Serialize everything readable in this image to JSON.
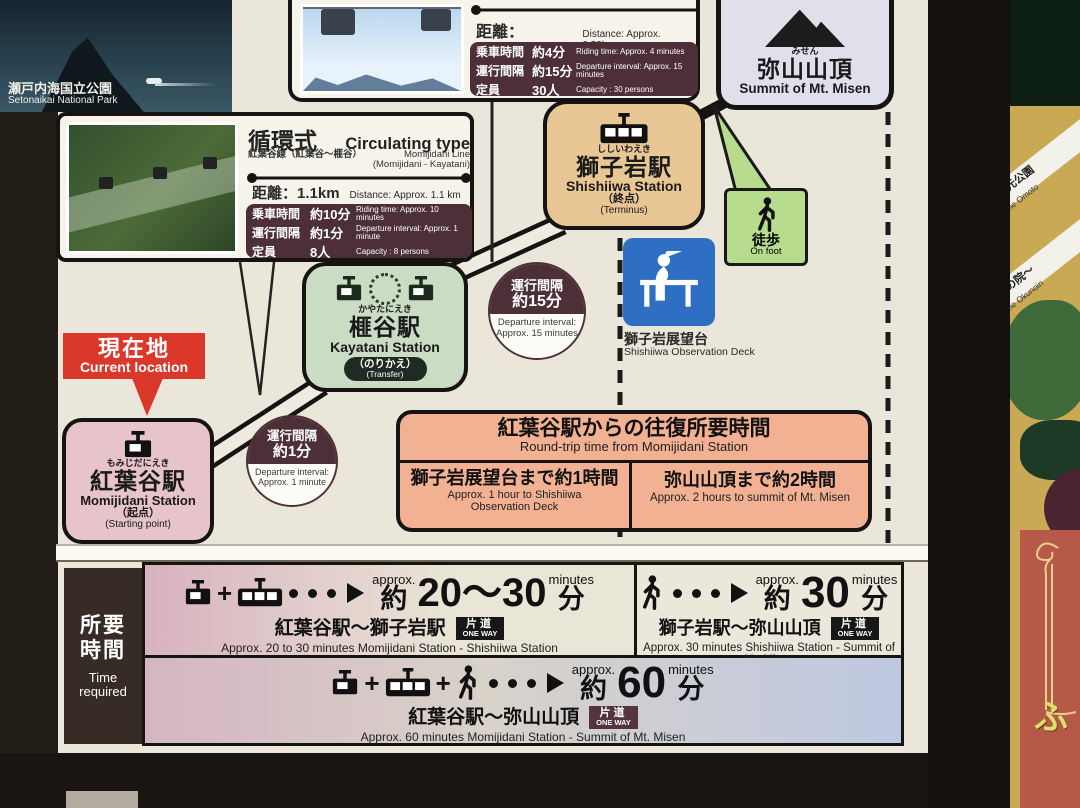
{
  "sign": {
    "island": {
      "jp": "瀬戸内海国立公園",
      "en": "Setonaikai National Park"
    },
    "top_line": {
      "distance_jp": "距離：0.52km",
      "distance_en": "Distance: Approx. 0.52km",
      "riding_jp": "乗車時間",
      "riding_v": "約4分",
      "riding_en": "Riding time: Approx. 4 minutes",
      "interval_jp": "運行間隔",
      "interval_v": "約15分",
      "interval_en": "Departure interval: Approx. 15 minutes",
      "capacity_jp": "定員",
      "capacity_v": "30人",
      "capacity_en": "Capacity : 30 persons"
    },
    "left_line": {
      "type_jp": "循環式",
      "type_en": "Circulating type",
      "line_jp": "紅葉谷線（紅葉谷〜榧谷）",
      "line_en1": "Momijidani Line",
      "line_en2": "(Momijidani - Kayatani)",
      "distance_jp": "距離：1.1km",
      "distance_en": "Distance: Approx. 1.1 km",
      "riding_jp": "乗車時間",
      "riding_v": "約10分",
      "riding_en": "Riding time: Approx. 10 minutes",
      "interval_jp": "運行間隔",
      "interval_v": "約1分",
      "interval_en": "Departure interval: Approx. 1 minute",
      "capacity_jp": "定員",
      "capacity_v": "8人",
      "capacity_en": "Capacity : 8 persons"
    },
    "summit": {
      "furigana": "みせん",
      "jp": "弥山山頂",
      "en": "Summit of Mt. Misen"
    },
    "stations": {
      "shishiiwa": {
        "furigana": "ししいわえき",
        "jp": "獅子岩駅",
        "en": "Shishiiwa Station",
        "note_jp": "（終点）",
        "note_en": "(Terminus)"
      },
      "kayatani": {
        "furigana": "かやたにえき",
        "jp": "榧谷駅",
        "en": "Kayatani Station",
        "note_jp": "（のりかえ）",
        "note_en": "(Transfer)"
      },
      "momijidani": {
        "furigana": "もみじだにえき",
        "jp": "紅葉谷駅",
        "en": "Momijidani Station",
        "note_jp": "（起点）",
        "note_en": "(Starting point)"
      }
    },
    "onfoot": {
      "jp": "徒歩",
      "en": "On foot"
    },
    "observation": {
      "jp": "獅子岩展望台",
      "en": "Shishiiwa Observation Deck"
    },
    "interval15": {
      "jp1": "運行間隔",
      "jp2": "約15分",
      "en1": "Departure interval:",
      "en2": "Approx. 15 minutes"
    },
    "interval1": {
      "jp1": "運行間隔",
      "jp2": "約1分",
      "en1": "Departure interval:",
      "en2": "Approx. 1 minute"
    },
    "current": {
      "jp": "現在地",
      "en": "Current location"
    },
    "roundtrip": {
      "title_jp": "紅葉谷駅からの往復所要時間",
      "title_en": "Round-trip time from Momijidani Station",
      "left_jp": "獅子岩展望台まで約1時間",
      "left_en1": "Approx. 1 hour to Shishiiwa",
      "left_en2": "Observation Deck",
      "right_jp": "弥山山頂まで約2時間",
      "right_en": "Approx. 2 hours to summit of Mt. Misen"
    },
    "timetable": {
      "header_jp1": "所要",
      "header_jp2": "時間",
      "header_en1": "Time",
      "header_en2": "required",
      "approx": "approx.",
      "minutes": "minutes",
      "yaku": "約",
      "fun": "分",
      "plus": "+",
      "row1a": {
        "value": "20〜30",
        "route_jp": "紅葉谷駅〜獅子岩駅",
        "oneway_jp": "片道",
        "oneway_en": "ONE WAY",
        "caption": "Approx. 20 to 30 minutes  Momijidani Station - Shishiiwa Station"
      },
      "row1b": {
        "value": "30",
        "route_jp": "獅子岩駅〜弥山山頂",
        "oneway_jp": "片道",
        "oneway_en": "ONE WAY",
        "caption": "Approx. 30 minutes Shishiiwa Station - Summit of Mt. Misen"
      },
      "row2": {
        "value": "60",
        "route_jp": "紅葉谷駅〜弥山山頂",
        "oneway_jp": "片道",
        "oneway_en": "ONE WAY",
        "caption": "Approx. 60 minutes Momijidani Station - Summit of Mt. Misen"
      }
    },
    "side": {
      "path1_jp": "至 大元公園",
      "path1_en": "To the Omoto",
      "path2_jp": "至 奥の院〜",
      "path2_en": "To the Okunoin",
      "poster_text": "ふ"
    },
    "colors": {
      "maroon": "#4c2f37",
      "shishiiwa_tan": "#e9c795",
      "kayatani_green": "#cbdcc5",
      "momijidani_pink": "#e7c3cb",
      "onfoot_green": "#b8dc8d",
      "current_red": "#d93a2b",
      "roundtrip_orange": "#f3b193",
      "observation_blue": "#2e6fc4"
    }
  }
}
